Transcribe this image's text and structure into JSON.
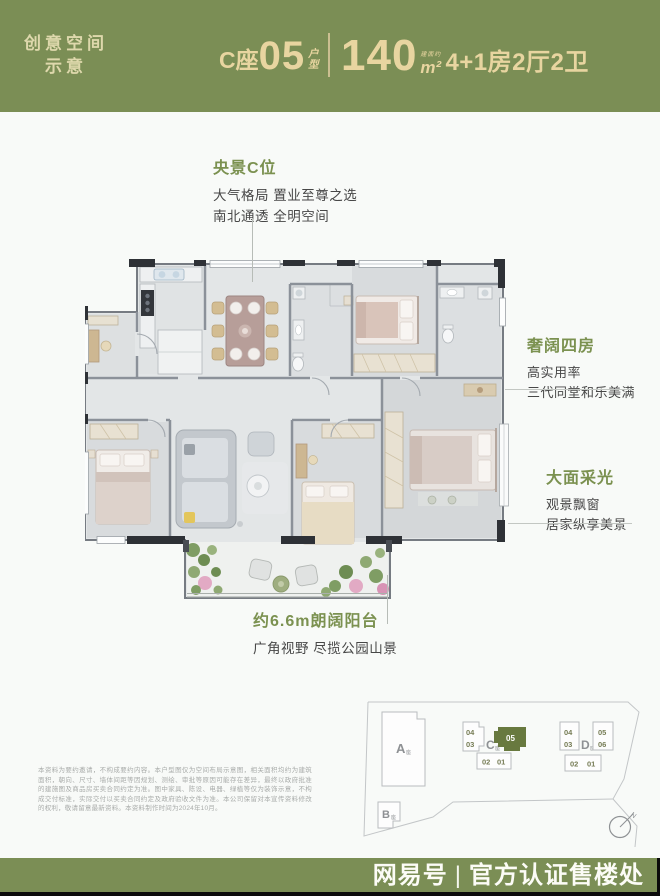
{
  "colors": {
    "background_green": "#7b8e55",
    "cream_text": "#e8d5a0",
    "heading_green": "#7b9150",
    "body_text": "#474747",
    "card_white": "#f8faf8",
    "site_highlight_green": "#68793f"
  },
  "header": {
    "badge_line1": "创意空间",
    "badge_line2": "示意",
    "building": "C座",
    "unit_number": "05",
    "unit_type_char1": "户",
    "unit_type_char2": "型",
    "area_prefix": "建面约",
    "area_value": "140",
    "area_unit": "m²",
    "layout_text": "4+1房2厅2卫"
  },
  "annotations": {
    "center_view": {
      "title": "央景C位",
      "line1": "大气格局 置业至尊之选",
      "line2": "南北通透 全明空间"
    },
    "four_rooms": {
      "title": "奢阔四房",
      "line1": "高实用率",
      "line2": "三代同堂和乐美满"
    },
    "daylight": {
      "title": "大面采光",
      "line1": "观景飘窗",
      "line2": "居家纵享美景"
    },
    "balcony": {
      "title": "约6.6m朗阔阳台",
      "line1": "广角视野 尽揽公园山景"
    }
  },
  "disclaimer": "本资料为要约邀请，不构成要约内容。本户型图仅为空间布局示意图，相关面积均约为建筑面积，朝向、尺寸、墙体间距等因规划、测绘、审批等原因可能存在差异，最终以政府批准的建施图及商品房买卖合同约定为准。图中家具、陈设、电器、绿植等仅为装饰示意，不构成交付标准，实际交付以买卖合同约定及政府验收文件为准。本公司保留对本宣传资料修改的权利，敬请留意最新资料。本资料制作时间为2024年10月。",
  "siteplan": {
    "building_a": "A",
    "building_b": "B",
    "building_c": "C",
    "building_d": "D",
    "building_suffix": "座",
    "highlighted_unit": "05",
    "c_units": {
      "u04": "04",
      "u03": "03",
      "u05": "05",
      "u02": "02",
      "u01": "01"
    },
    "d_units": {
      "u04": "04",
      "u03": "03",
      "u05": "05",
      "u06": "06",
      "u02": "02",
      "u01": "01"
    },
    "compass": "N"
  },
  "footer": {
    "brand": "网易号",
    "separator": "|",
    "text": "官方认证售楼处"
  }
}
